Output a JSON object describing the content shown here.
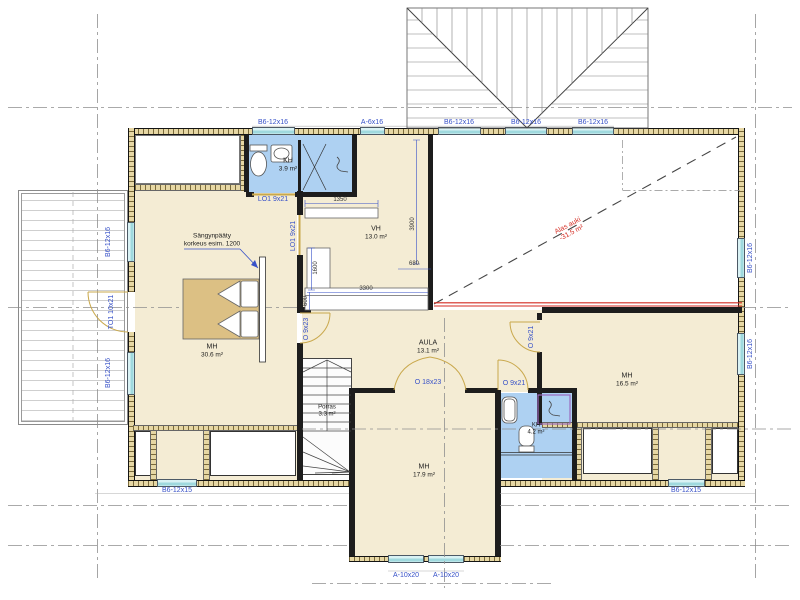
{
  "drawing": {
    "windows": {
      "top": [
        "B6-12x16",
        "A-6x16",
        "B6-12x16",
        "B6-12x16",
        "B6-12x16"
      ],
      "left": [
        "B6-12x16",
        "B6-12x16"
      ],
      "right": [
        "B6-12x16",
        "B6-12x16"
      ],
      "bottom": [
        "B6-12x15",
        "B6-12x15"
      ],
      "south": [
        "A-10x20",
        "A-10x20"
      ]
    },
    "doors": {
      "terrace": "TO1 10x21",
      "kh_sliding": "LO1 9x21",
      "vh_sliding": "LO1 9x21",
      "mh_left": "O 9x23",
      "aula_double": "O 18x23",
      "mh_right": "O 9x21",
      "kh2": "O 9x21"
    },
    "rooms": [
      {
        "name": "KH",
        "area": "3.9 m²"
      },
      {
        "name": "VH",
        "area": "13.0 m²"
      },
      {
        "name": "MH",
        "area": "30.6 m²"
      },
      {
        "name": "AULA",
        "area": "13.1 m²"
      },
      {
        "name": "Porras",
        "area": "3.3 m²"
      },
      {
        "name": "MH",
        "area": "16.5 m²"
      },
      {
        "name": "KH",
        "area": "4.2 m²"
      },
      {
        "name": "MH",
        "area": "17.9 m²"
      }
    ],
    "open_to_below": {
      "line1": "Alas auki",
      "line2": "-31.5 m²"
    },
    "annotation": {
      "line1": "Sängynpääty",
      "line2": "korkeus esim. 1200"
    },
    "dims": [
      "1350",
      "1600",
      "3300",
      "600",
      "3900",
      "680"
    ],
    "colors": {
      "floor": "#f4ecd4",
      "wet_room": "#aed1f2",
      "window_glass": "#cdeef2",
      "label_blue": "#3751c8",
      "warning_red": "#d42a20",
      "wall_hatch": "#e6d7a4",
      "bed": "#dcc084"
    }
  }
}
